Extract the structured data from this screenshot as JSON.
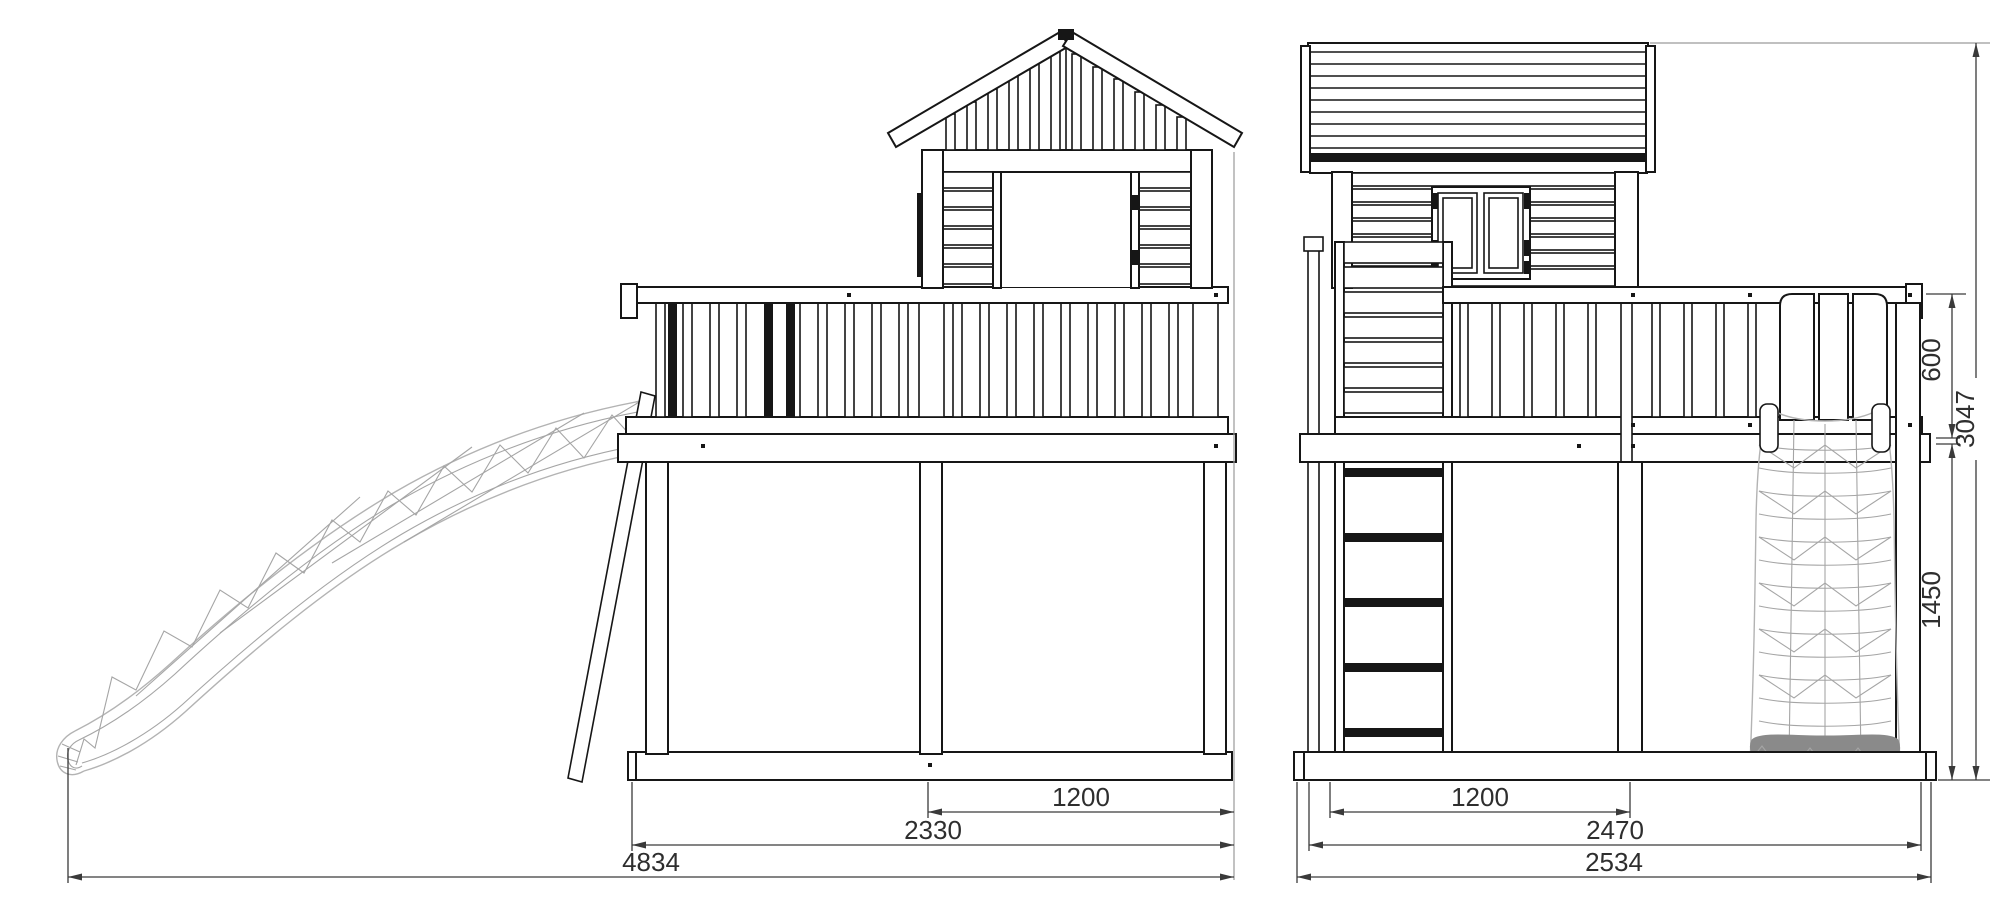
{
  "drawing": {
    "type": "playground-tower-dimension-drawing",
    "background_color": "#ffffff",
    "line_color": "#161616",
    "mesh_color": "#b3b3b3",
    "dimension_line_color": "#3a3a3a",
    "dimension_text_color": "#2e2e2e"
  },
  "views": {
    "side_view": {
      "name": "side-elevation-with-slide-playhouse-and-gable-roof",
      "dimensions": {
        "inner_bay": "1200",
        "platform_depth": "2330",
        "total_length": "4834"
      }
    },
    "front_view": {
      "name": "front-elevation-with-ladder-climbing-wall-and-net",
      "dimensions": {
        "inner_bay": "1200",
        "frame_width": "2470",
        "total_width": "2534",
        "railing_height": "600",
        "total_height": "3047",
        "platform_height": "1450"
      }
    }
  }
}
